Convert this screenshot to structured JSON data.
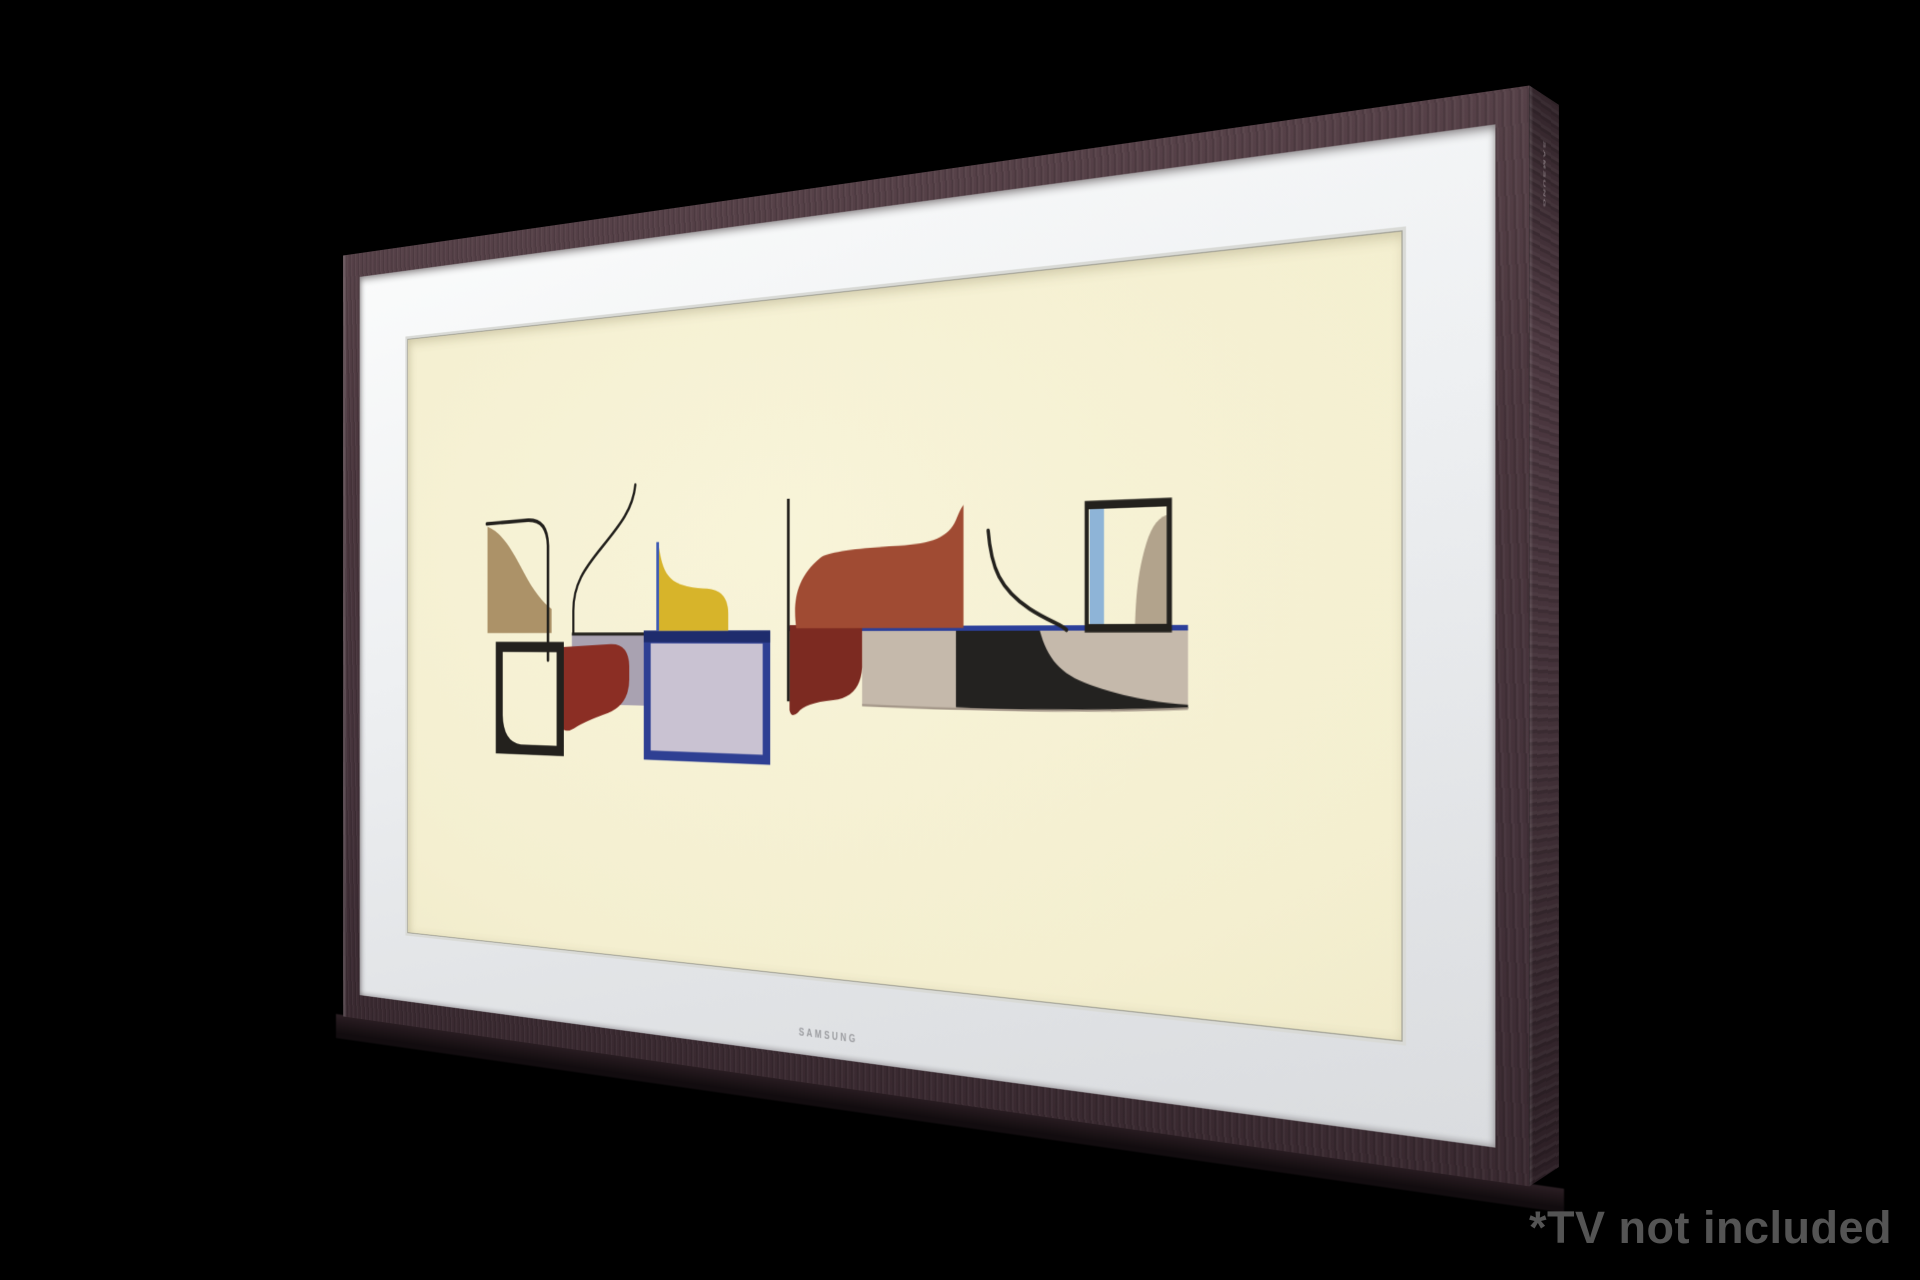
{
  "page": {
    "background": "#000000"
  },
  "disclaimer": {
    "text": "*TV not included",
    "color": "#545454"
  },
  "product": {
    "name": "the-frame-tv",
    "frame_wood_color": "#4a363d",
    "matte_color": "#eef0f2",
    "side_logo": "SAMSUNG",
    "matte_logo": "SAMSUNG"
  },
  "artwork": {
    "description": "Abstract mid-century gouache shapes on cream paper",
    "canvas_color": "#f4efd0",
    "colors": {
      "ink": "#23211d",
      "tan": "#ac9268",
      "lavender": "#a9a2b1",
      "navy": "#2e3f93",
      "navy_dark": "#1e2c6d",
      "navy_fill": "#c9c2d2",
      "yellow": "#d7b42a",
      "blue_accent": "#3d5ab4",
      "blue_line": "#2b3f9a",
      "red": "#8b2e24",
      "dark_red": "#7c2a21",
      "rust": "#a04b33",
      "beige": "#c5b9ab",
      "band_black": "#232220",
      "band_edge": "#a5988a",
      "window_blue": "#8eb4d7",
      "window_tan": "#b2a38c"
    }
  }
}
